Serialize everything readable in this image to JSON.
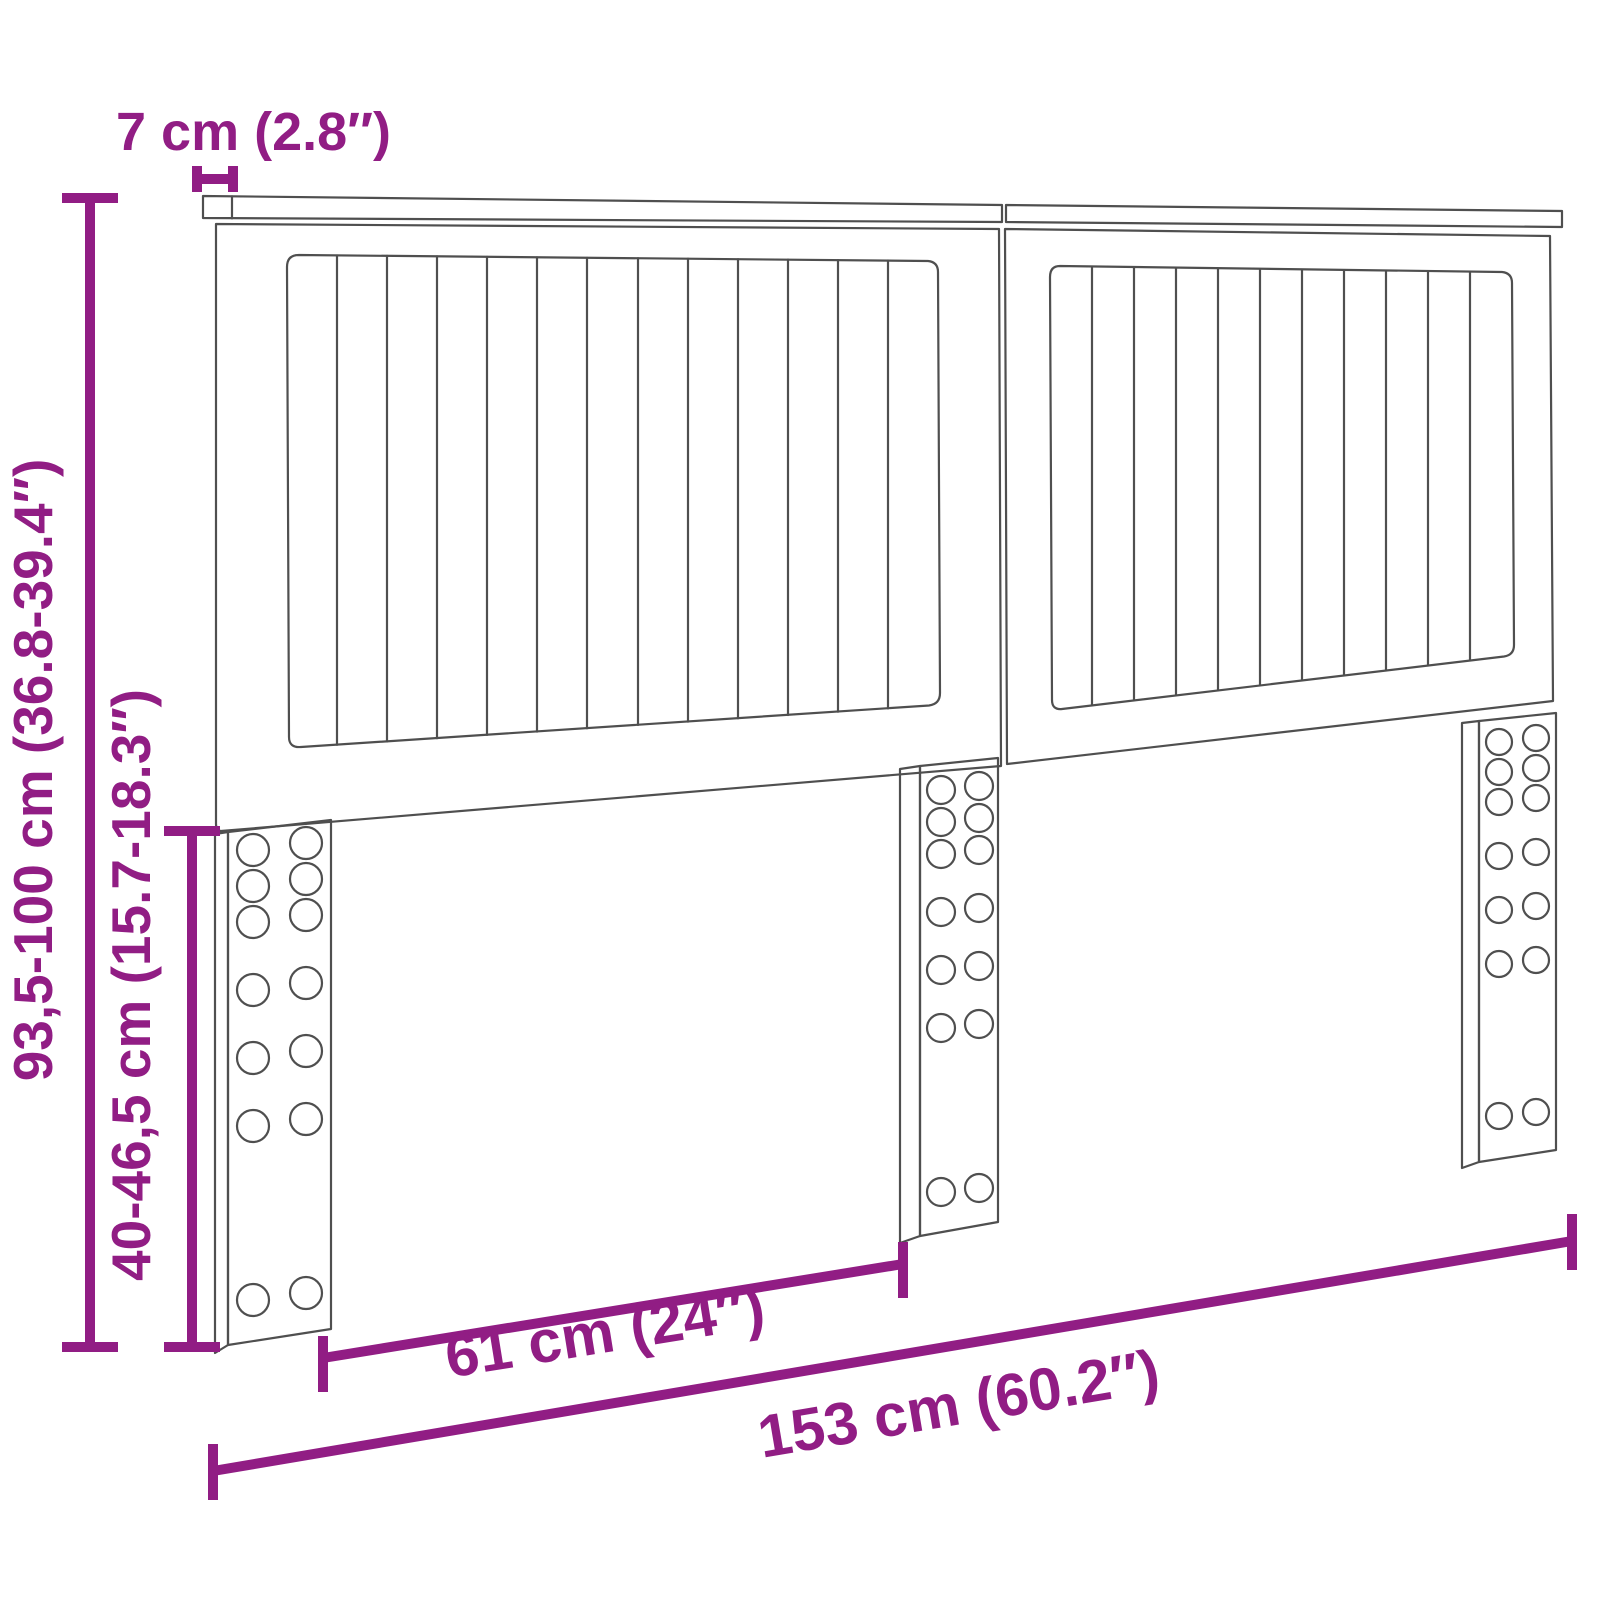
{
  "title": "Headboard dimension diagram",
  "colors": {
    "dimension": "#911d84",
    "outline": "#4f4f4f",
    "background": "#ffffff"
  },
  "dimensions": {
    "top_rail_depth": {
      "label": "7 cm (2.8″)",
      "value_cm": "7",
      "value_in": "2.8"
    },
    "total_height": {
      "label": "93,5-100 cm (36.8-39.4″)",
      "value_cm": "93,5-100",
      "value_in": "36.8-39.4"
    },
    "leg_height": {
      "label": "40-46,5 cm (15.7-18.3″)",
      "value_cm": "40-46,5",
      "value_in": "15.7-18.3"
    },
    "leg_spacing": {
      "label": "61 cm (24″)",
      "value_cm": "61",
      "value_in": "24"
    },
    "total_width": {
      "label": "153 cm (60.2″)",
      "value_cm": "153",
      "value_in": "60.2"
    }
  }
}
